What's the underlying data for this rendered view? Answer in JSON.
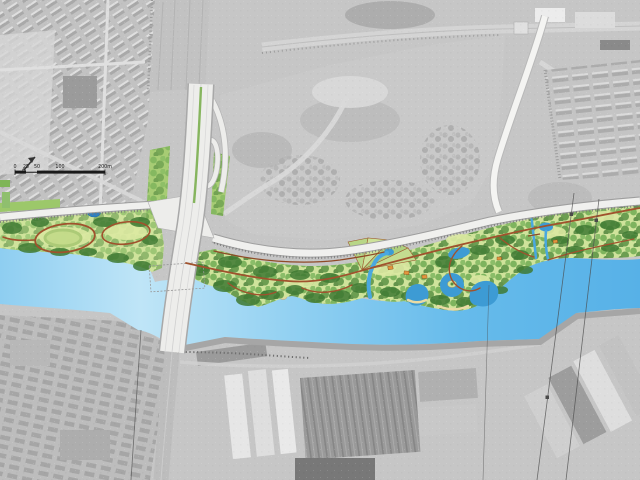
{
  "map": {
    "scale_bar": {
      "labels": [
        "0",
        "25",
        "50",
        "100",
        "200m"
      ]
    },
    "icons": {
      "north_arrow": "north-arrow"
    },
    "colors": {
      "river_light": "#bfe5f7",
      "river_deep": "#57b1e7",
      "pond": "#3d9bd4",
      "pond_dark": "#2e7fc0",
      "stream": "#4aa8e0",
      "lawn": "#cfe39b",
      "lawn_light": "#dce9a2",
      "canopy": "#6aa84f",
      "canopy_dark": "#3f7a33",
      "trail": "#a0522d",
      "trail_dark": "#8f4a28",
      "road_fill": "#f0f0ee",
      "road_edge": "#9e9e9e",
      "bridge_deck": "#ededeb",
      "median": "#86b55e",
      "island": "#ddd3a0",
      "beach": "#e9dba4",
      "embankment": "#a6a6a6",
      "pavilion": "#e2953d",
      "aerial_base": "#c6c6c6",
      "scale_text": "#1a1a1a"
    }
  }
}
